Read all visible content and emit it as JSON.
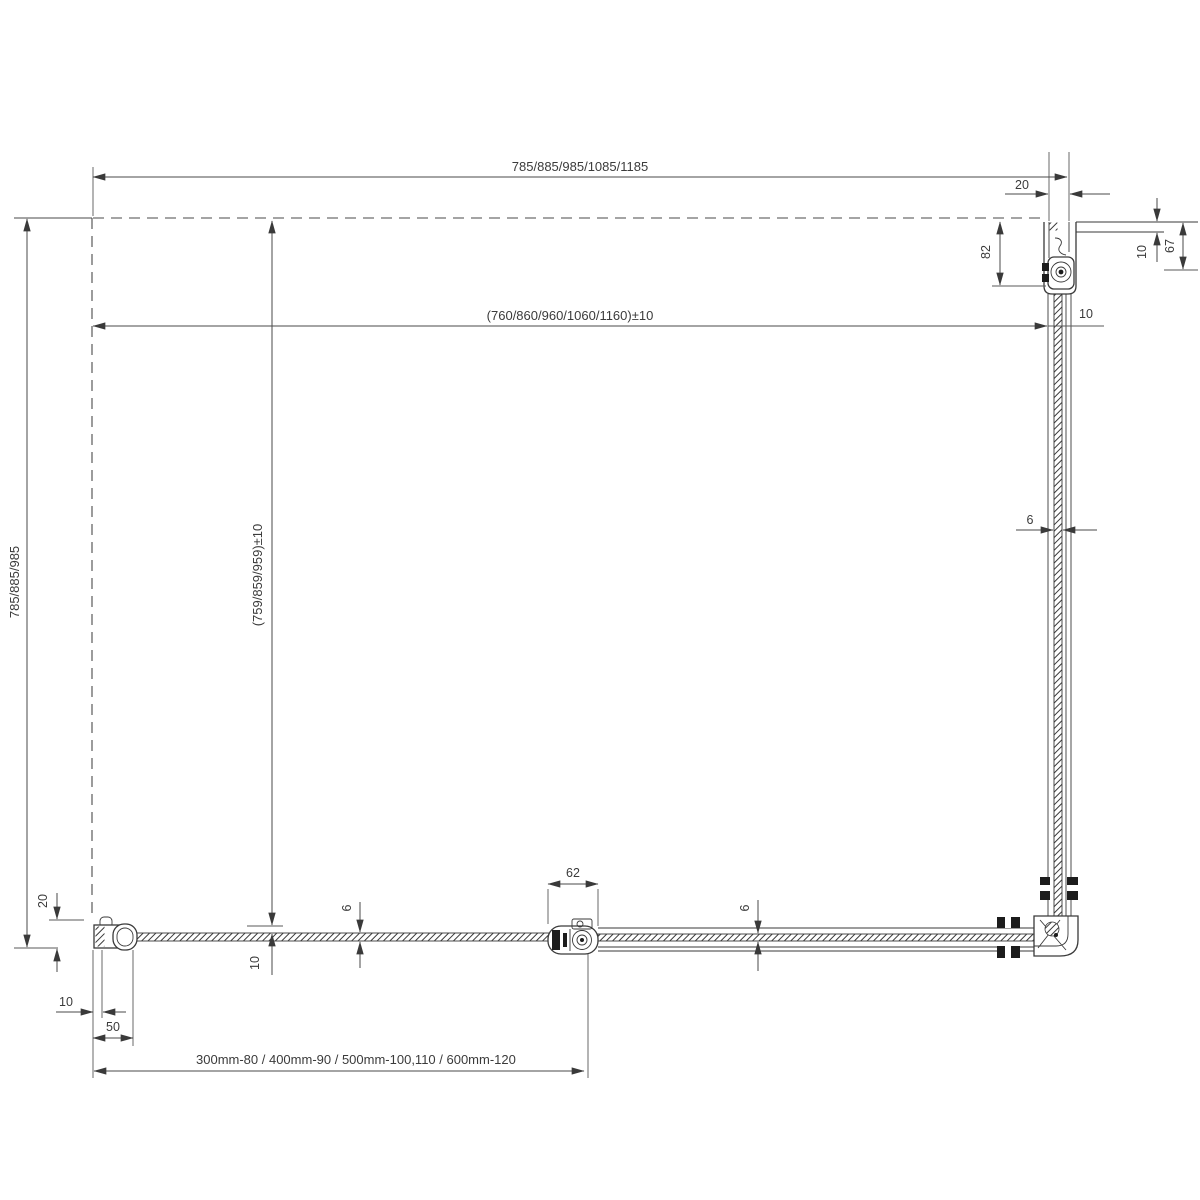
{
  "drawing": {
    "kind": "technical plan view of corner shower enclosure with pivot door",
    "colors": {
      "background": "#ffffff",
      "lines": "#3a3a3a",
      "dimensions": "#4a4a4a",
      "text": "#3b3b3b",
      "clamps": "#1c1c1c"
    },
    "labels": {
      "width_options": "785/885/985/1085/1185",
      "glass_width_options": "(760/860/960/1060/1160)±10",
      "depth_options": "785/885/985",
      "glass_depth_options": "(759/859/959)±10",
      "top_profile_inner": "20",
      "hinge_offset_top": "82",
      "panel_gap_top_right": "10",
      "wall_profile_depth_right": "67",
      "glass_offset_right": "10",
      "glass_thickness_right_panel": "6",
      "wall_profile_adjust_left": "20",
      "wall_gap_bottom_left": "10",
      "wall_profile_width": "50",
      "door_gap_bottom": "10",
      "door_glass_thickness": "6",
      "hinge_width": "62",
      "bottom_panel_glass_thickness": "6",
      "tray_compatibility_note": "300mm-80 / 400mm-90 / 500mm-100,110 / 600mm-120"
    }
  }
}
